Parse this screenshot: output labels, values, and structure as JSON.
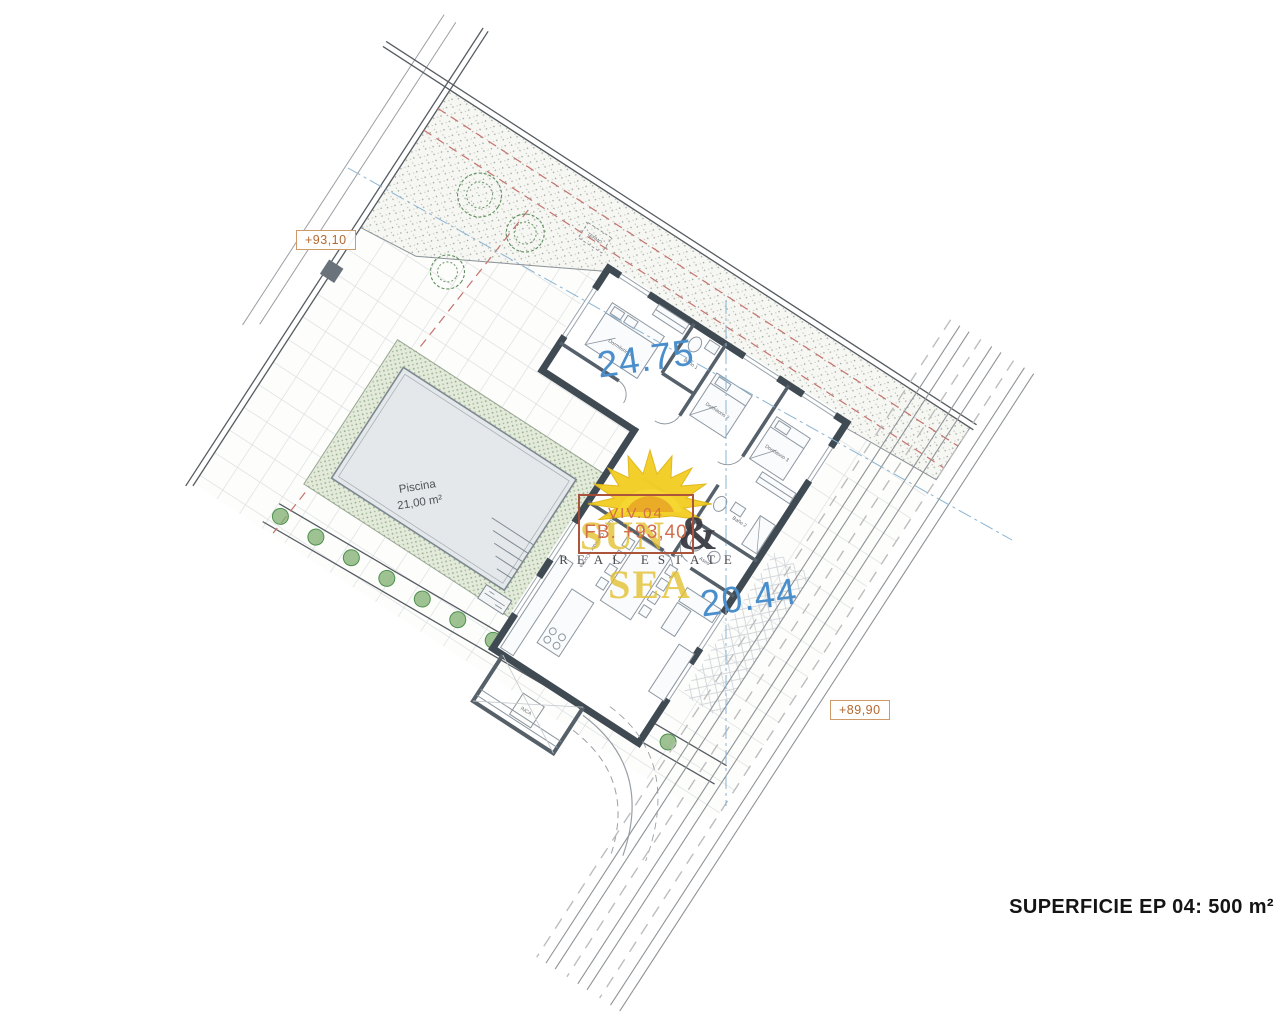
{
  "plan": {
    "areas": {
      "bedrooms_zone": "24.75",
      "living_zone": "20.44"
    },
    "pool": {
      "name": "Piscina",
      "area": "21,00 m²"
    },
    "levels": {
      "terrace": "+93,10",
      "street": "+89,90"
    },
    "rooms": {
      "master": "Dormitorio 1",
      "bedroom2": "Dormitorio 2",
      "bedroom3": "Dormitorio 3",
      "bath1": "Baño 1",
      "bath2": "Baño 2",
      "toilet": "Aseo",
      "hall": "Distribuidor",
      "living": "Salón - Comedor - Cocina",
      "equipment": "TERMO",
      "drain": "INCA"
    },
    "footer": {
      "superficie": "SUPERFICIE EP 04: 500 m²"
    }
  },
  "watermark": {
    "ref": "VIV.04",
    "level": "FB. +93,40",
    "brand1": "SUN",
    "amp": "&",
    "brand2": "SEA",
    "tagline": "REAL ESTATE"
  },
  "colors": {
    "wall": "#3f4a53",
    "area_text": "#4a8ecb",
    "elevation_text": "#b4682f",
    "watermark_yellow": "#e3bf2b",
    "watermark_orange": "#cf6742",
    "red_dashed": "#c4736e",
    "blue_guide": "#8ab4d2",
    "deck_green": "#8fa989"
  }
}
